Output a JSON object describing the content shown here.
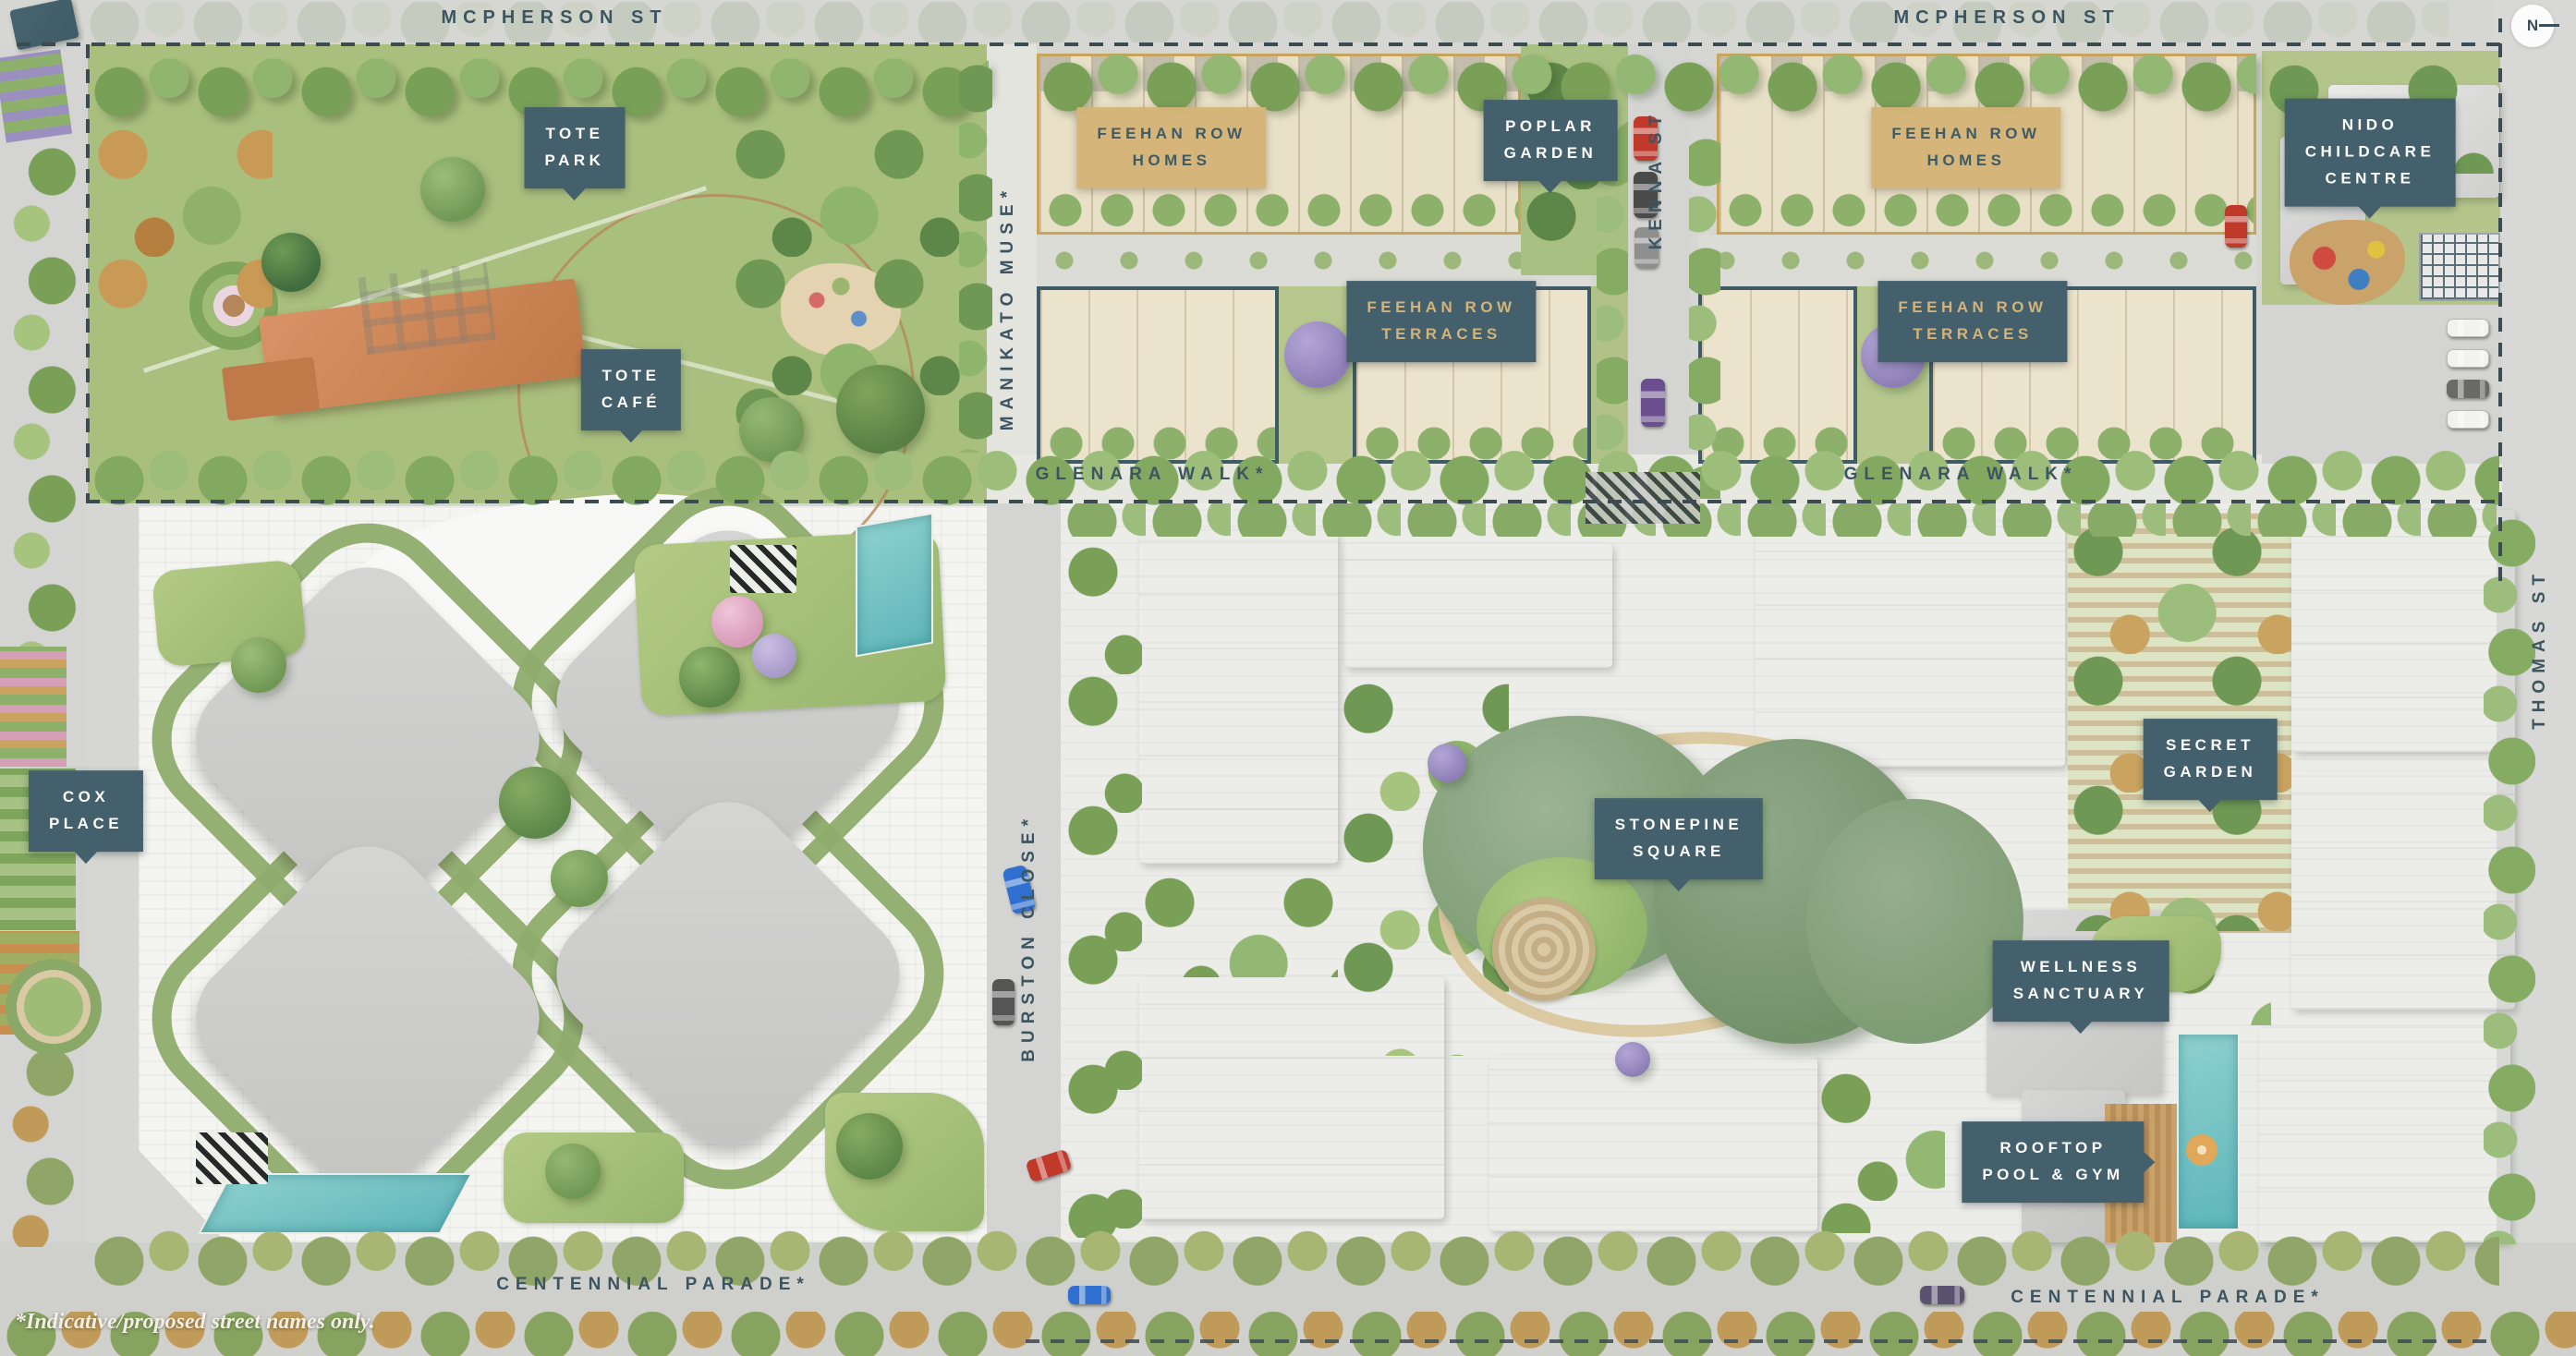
{
  "map_title": "Residential development masterplan (illustrated site plan)",
  "streets": {
    "mcpherson_left": "MCPHERSON ST",
    "mcpherson_right": "MCPHERSON ST",
    "kenna": "KENNA ST",
    "manikato": "MANIKATO MUSE*",
    "glenara_left": "GLENARA WALK*",
    "glenara_right": "GLENARA WALK*",
    "burston": "BURSTON CLOSE*",
    "thomas": "THOMAS ST",
    "centennial_left": "CENTENNIAL PARADE*",
    "centennial_right": "CENTENNIAL PARADE*"
  },
  "places": {
    "tote_park": "TOTE\nPARK",
    "tote_cafe": "TOTE\nCAFÉ",
    "feehan_homes_left": "FEEHAN ROW\nHOMES",
    "feehan_homes_right": "FEEHAN ROW\nHOMES",
    "feehan_terraces_left": "FEEHAN ROW\nTERRACES",
    "feehan_terraces_right": "FEEHAN ROW\nTERRACES",
    "poplar_garden": "POPLAR\nGARDEN",
    "nido_childcare": "NIDO\nCHILDCARE\nCENTRE",
    "cox_place": "COX\nPLACE",
    "stonepine_square": "STONEPINE\nSQUARE",
    "secret_garden": "SECRET\nGARDEN",
    "wellness_sanctuary": "WELLNESS\nSANCTUARY",
    "rooftop_pool_gym": "ROOFTOP\nPOOL & GYM"
  },
  "compass": "N",
  "footnote": "*Indicative/proposed street names only.",
  "colors": {
    "label_teal": "#44606c",
    "label_tan": "#d3b377",
    "street_text": "#3d5560",
    "grass": "#a9bf7e",
    "tree_green": "#82a75f",
    "building_gray": "#c9c9c8",
    "townhome_beige": "#e9e0c8",
    "pool_teal": "#72c3c5",
    "road_gray": "#d4d5d2",
    "paving_white": "#f4f4f1",
    "cafe_orange": "#cd8454",
    "boundary_dash": "#3c4a52"
  }
}
